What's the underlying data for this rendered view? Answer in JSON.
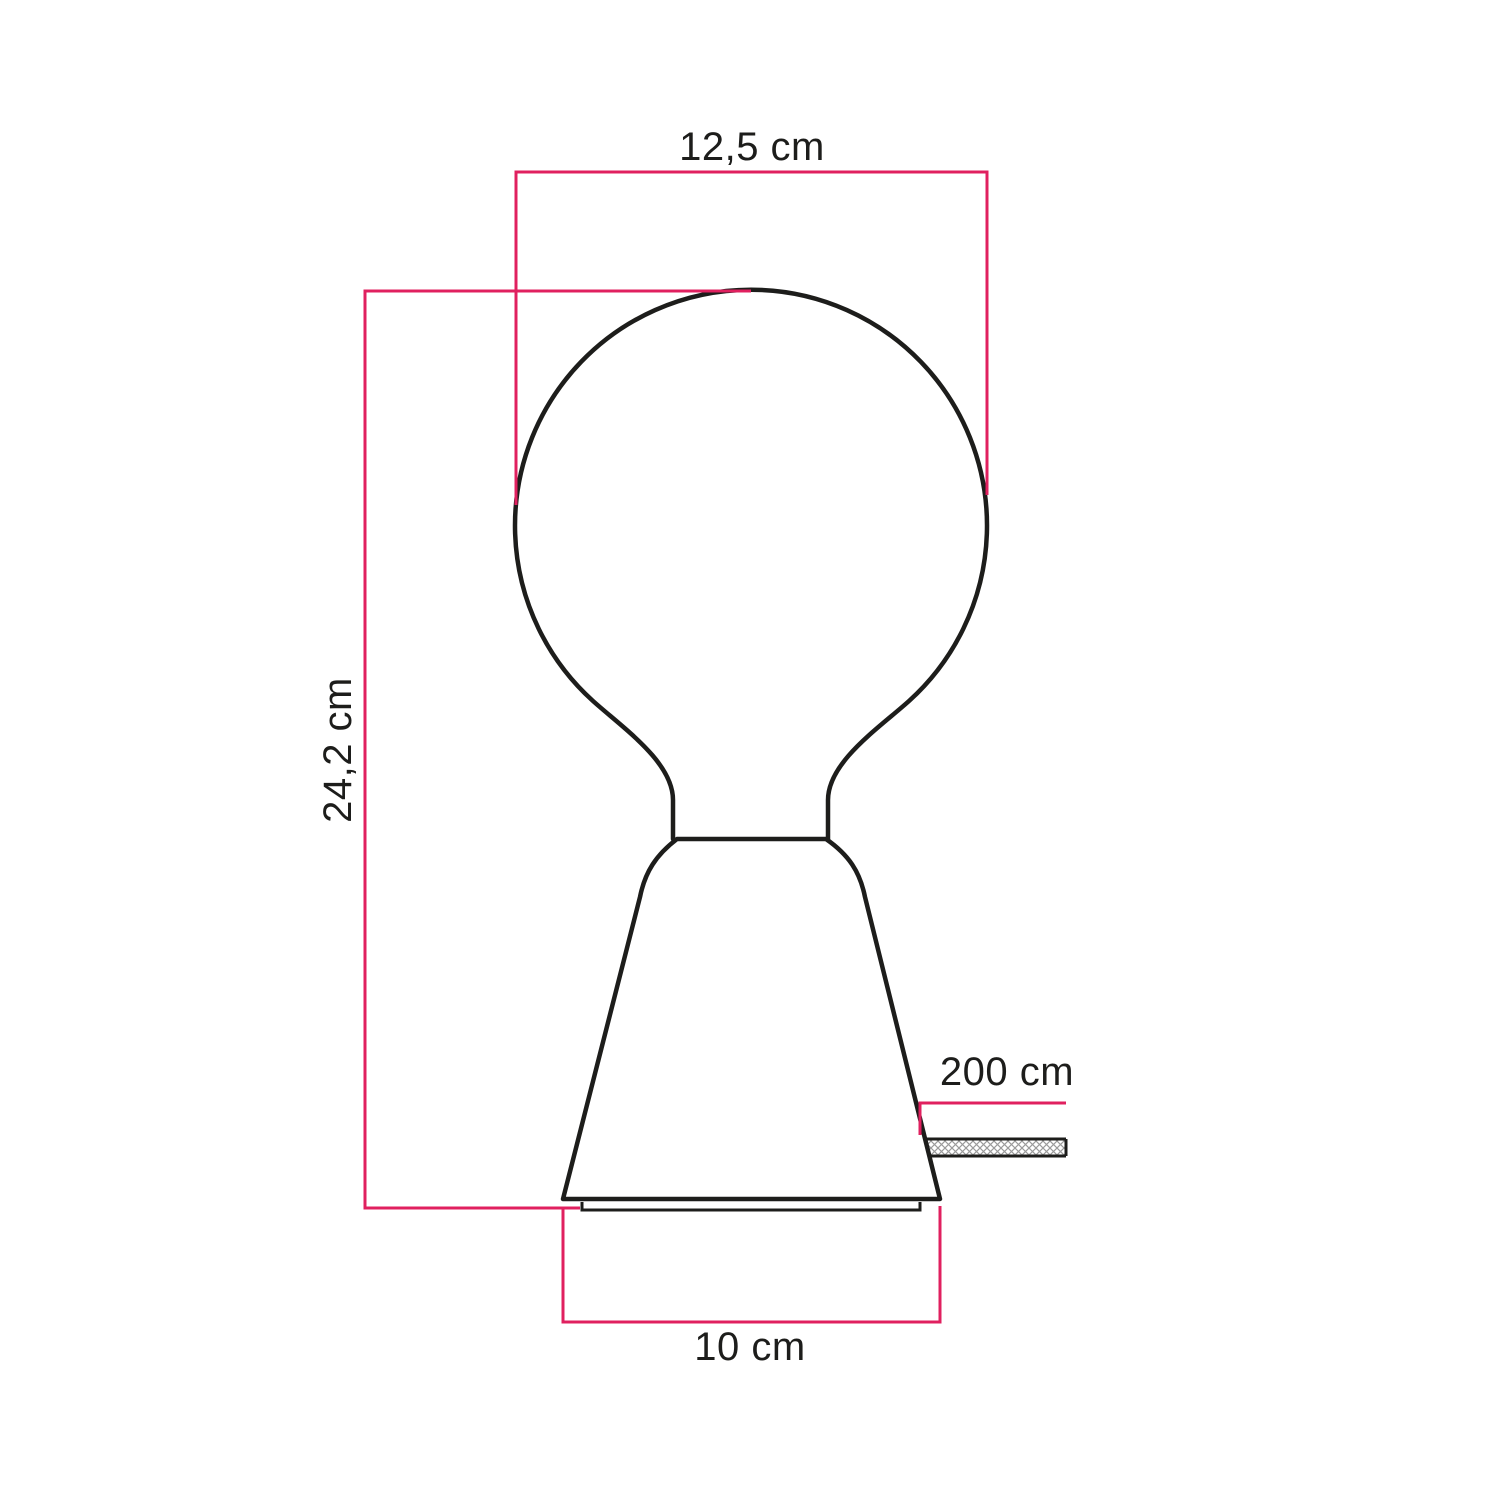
{
  "diagram": {
    "kind": "product-dimension-drawing",
    "subject": "table lamp with globe bulb and conical base plus fabric cable"
  },
  "colors": {
    "dimension_pink": "#e0205f",
    "outline_black": "#1d1d1b",
    "hatch_gray": "#9b9b9b",
    "background": "#ffffff"
  },
  "labels": {
    "bulb_width": "12,5 cm",
    "total_height": "24,2 cm",
    "cable_length": "200 cm",
    "base_width": "10 cm"
  }
}
